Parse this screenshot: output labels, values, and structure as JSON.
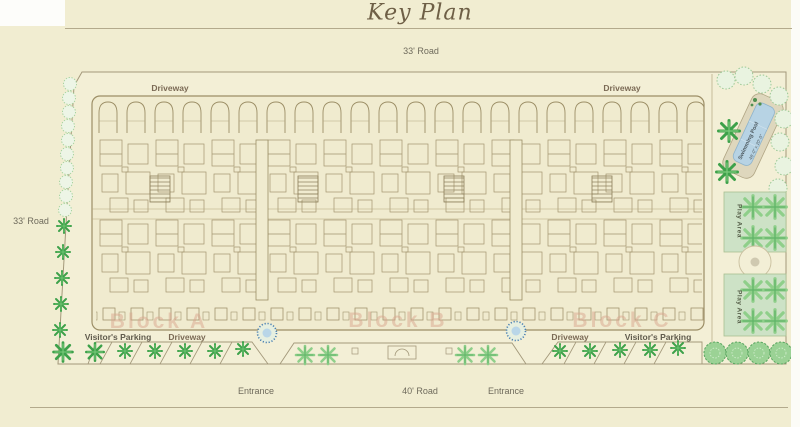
{
  "title": "Key Plan",
  "roads": {
    "top": "33' Road",
    "left": "33' Road",
    "bottom": "40' Road"
  },
  "entrances": {
    "left": "Entrance",
    "right": "Entrance"
  },
  "driveways": {
    "top_left": "Driveway",
    "top_right": "Driveway",
    "bottom_left": "Driveway",
    "bottom_right": "Driveway"
  },
  "parking": {
    "left": "Visitor's Parking",
    "right": "Visitor's Parking"
  },
  "blocks": {
    "a": "Block A",
    "b": "Block B",
    "c": "Block C"
  },
  "amenities": {
    "pool_label": "Swimming Pool",
    "pool_size": "46'-0\" x 20'-0\"",
    "play_area_top": "Play Area",
    "play_area_bottom": "Play Area"
  },
  "colors": {
    "background": "#f1edd1",
    "plan_line": "#9c8e66",
    "tree_green": "#3da14a",
    "pool_blue": "#b7d3e4",
    "play_area_fill": "#cde2c6",
    "block_text": "#d8a08a",
    "fountain_blue": "#4a80b2"
  }
}
